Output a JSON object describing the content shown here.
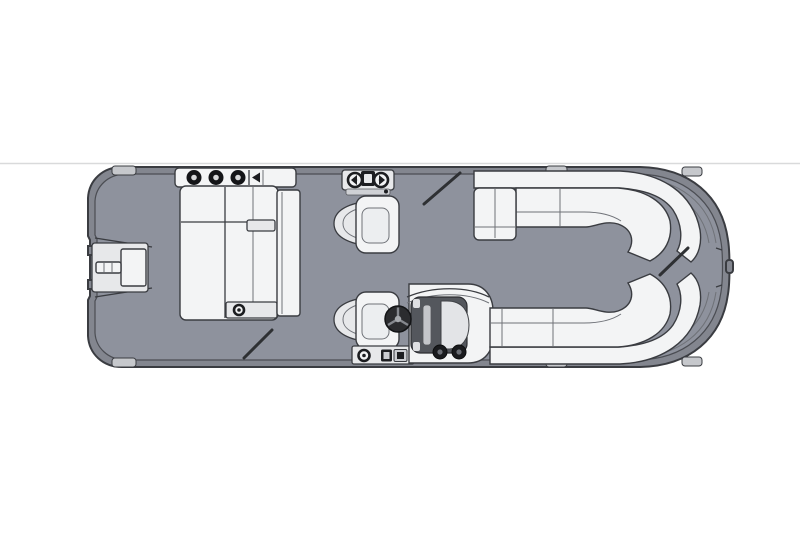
{
  "meta": {
    "title": "Pontoon boat floor plan — top view diagram",
    "type": "boat-floorplan-diagram"
  },
  "colors": {
    "background": "#ffffff",
    "divider": "#d9dadb",
    "deck": "#8e929d",
    "hull": "#83868f",
    "outline": "#3a3c41",
    "furniture": "#f3f4f5",
    "furniture_shade": "#e7e8ea",
    "furniture_cushion": "#eceef0",
    "dark_detail": "#1d1e21",
    "console_dark": "#54575d",
    "wheel": "#2b2c2f",
    "gate_line": "#2e3033",
    "rail_block": "#c6c8cc"
  },
  "components": {
    "hull": {
      "label": "pontoon hull with rub-rail and deck"
    },
    "stern_platform": {
      "label": "stern boarding platform with swim ladder"
    },
    "rear_lounger": {
      "label": "aft L-shaped lounge group",
      "speaker_count": 3
    },
    "port_gate_latch": {
      "label": "port side gate latch hardware"
    },
    "companion_chair": {
      "label": "companion captain's chair, forward facing"
    },
    "helm": {
      "label": "helm station with console, steering wheel and captain's chair",
      "gauge_count": 2
    },
    "port_bow_bench": {
      "label": "port bow L-shaped lounge bench with curved corner"
    },
    "starboard_bow_bench": {
      "label": "starboard bow lounge bench with curved corner"
    },
    "gates": {
      "label": "gate swing indicators",
      "count": 3,
      "positions": [
        "stern walkway",
        "port side",
        "bow center"
      ]
    },
    "rail_cleats": {
      "label": "rail cleat blocks",
      "count": 6
    },
    "bow_light": {
      "label": "bow navigation light / gate latch nub"
    }
  }
}
